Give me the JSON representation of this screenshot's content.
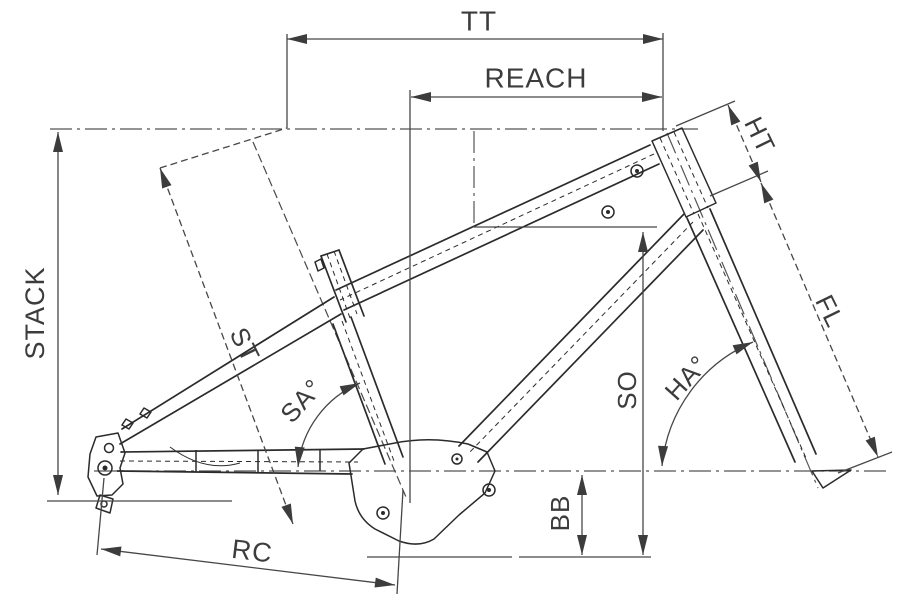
{
  "diagram": {
    "type": "bicycle-frame-geometry",
    "background_color": "#ffffff",
    "line_color": "#3c3c3c",
    "dimension_labels": {
      "top_tube": "TT",
      "reach": "REACH",
      "stack": "STACK",
      "seat_tube": "ST",
      "seat_angle": "SA°",
      "standover": "SO",
      "head_angle": "HA°",
      "bottom_bracket_drop": "BB",
      "rear_center": "RC",
      "head_tube": "HT",
      "fork_length": "FL"
    }
  }
}
